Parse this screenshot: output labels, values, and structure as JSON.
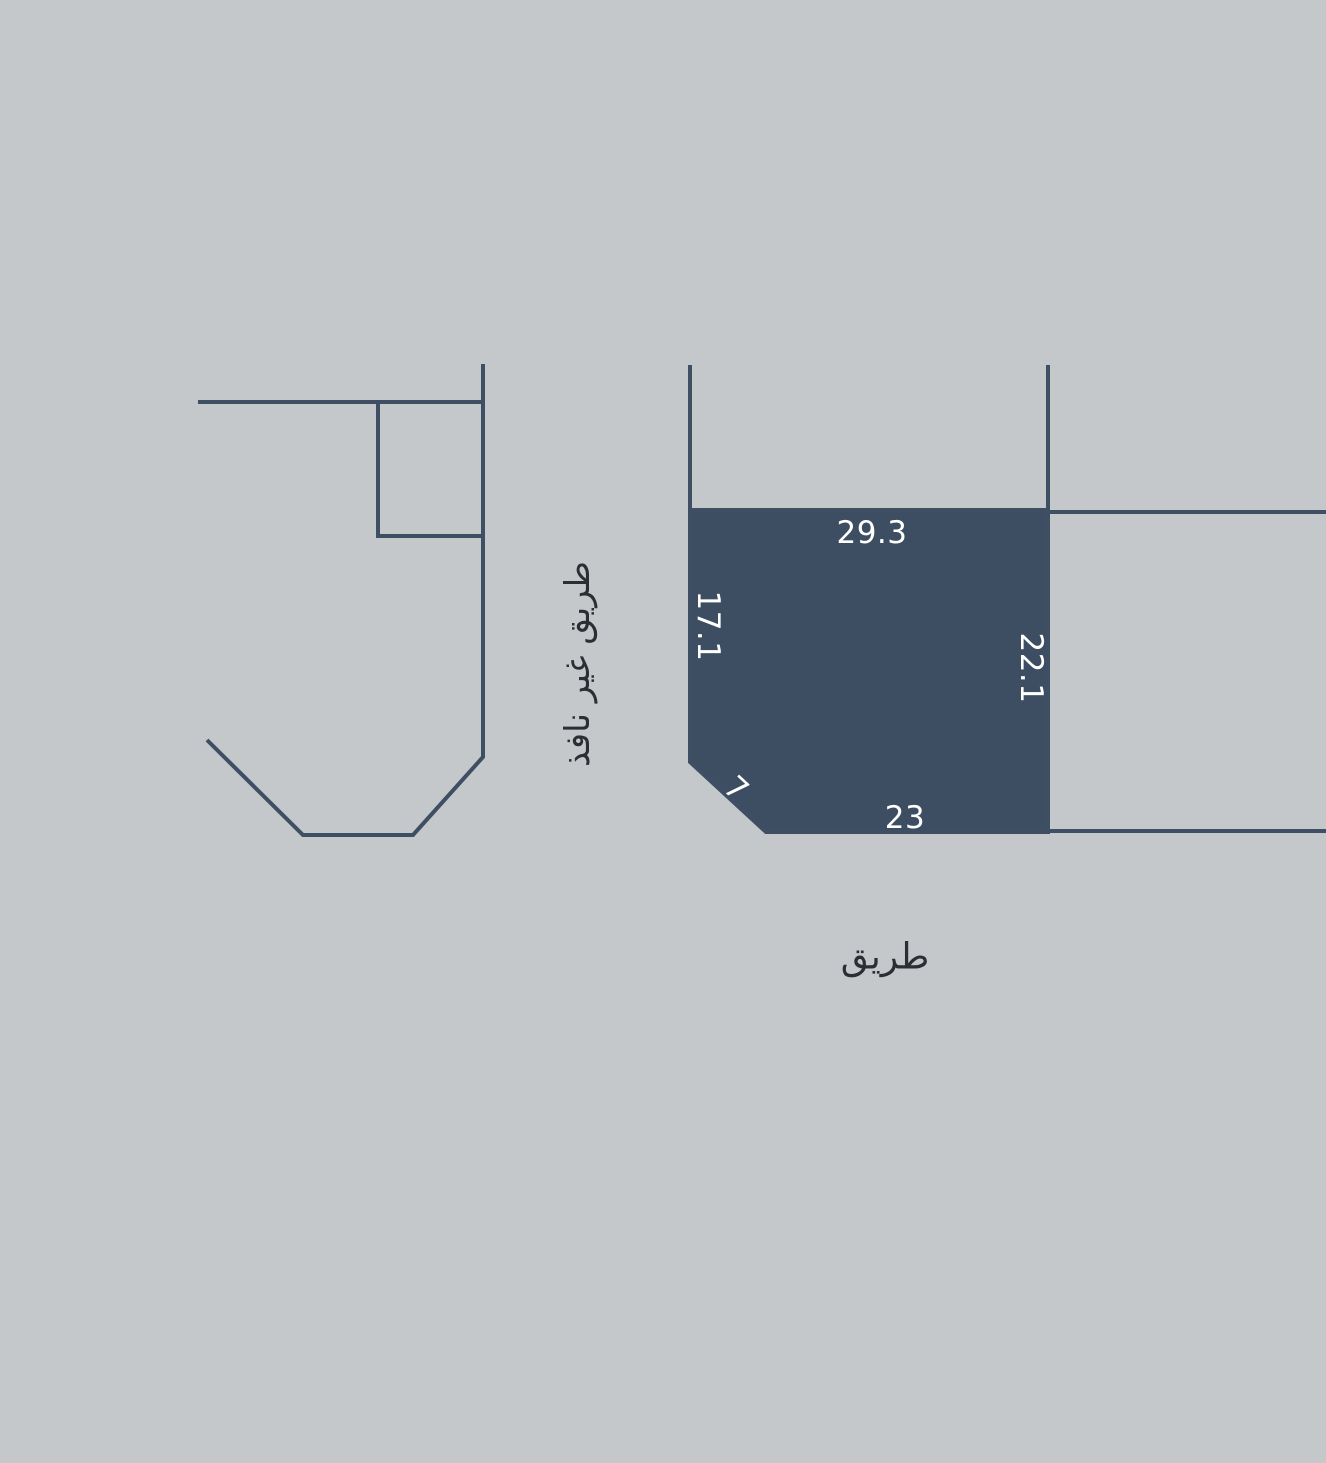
{
  "scene": {
    "background_color": "#c4c8cb",
    "line_color": "#3e4f63",
    "parcel": {
      "fill_color": "#3e4e62",
      "dimension_text_color": "#ffffff",
      "dimensions": {
        "top": "29.3",
        "left": "17.1",
        "right": "22.1",
        "bottom": "23",
        "chamfer": "7"
      }
    },
    "roads": {
      "text_color": "#2b2f34",
      "dead_end_road": "طريق غير نافذ",
      "main_road": "طريق"
    }
  }
}
